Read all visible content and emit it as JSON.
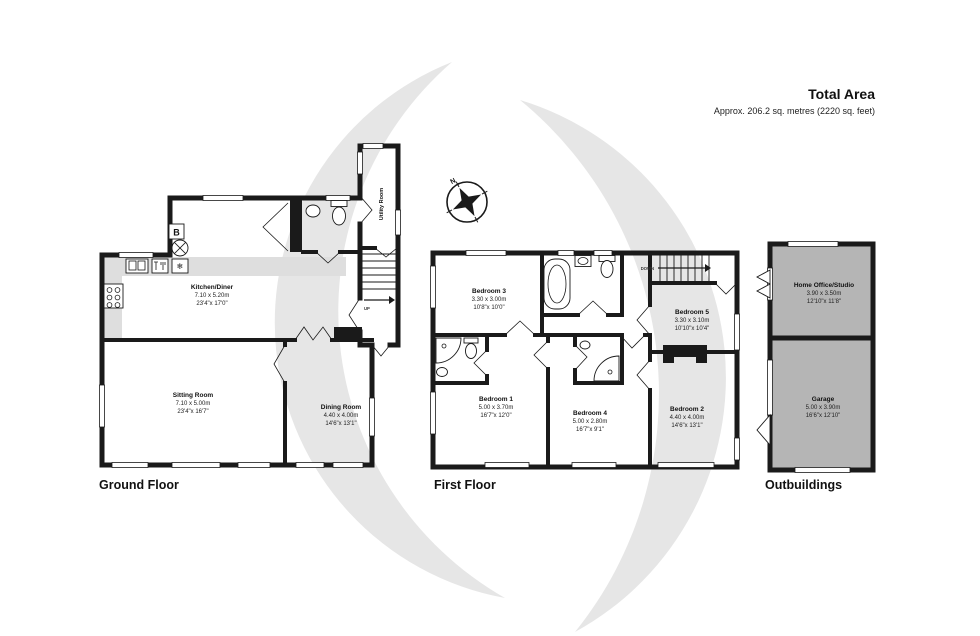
{
  "header": {
    "title": "Total Area",
    "subtitle": "Approx. 206.2 sq. metres (2220 sq. feet)"
  },
  "compass": {
    "north": "N"
  },
  "ground": {
    "label": "Ground Floor",
    "kitchen": {
      "name": "Kitchen/Diner",
      "metric": "7.10 x 5.20m",
      "imperial": "23'4\"x 17'0\""
    },
    "sitting": {
      "name": "Sitting Room",
      "metric": "7.10 x 5.00m",
      "imperial": "23'4\"x 16'7\""
    },
    "dining": {
      "name": "Dining Room",
      "metric": "4.40 x 4.00m",
      "imperial": "14'6\"x 13'1\""
    },
    "utility": {
      "name": "Utility Room"
    },
    "stairs_direction": "UP",
    "boiler_label": "B"
  },
  "first": {
    "label": "First Floor",
    "bedroom3": {
      "name": "Bedroom 3",
      "metric": "3.30 x 3.00m",
      "imperial": "10'8\"x 10'0\""
    },
    "bedroom5": {
      "name": "Bedroom 5",
      "metric": "3.30 x 3.10m",
      "imperial": "10'10\"x 10'4\""
    },
    "bedroom1": {
      "name": "Bedroom 1",
      "metric": "5.00 x 3.70m",
      "imperial": "16'7\"x 12'0\""
    },
    "bedroom4": {
      "name": "Bedroom 4",
      "metric": "5.00 x 2.80m",
      "imperial": "16'7\"x 9'1\""
    },
    "bedroom2": {
      "name": "Bedroom 2",
      "metric": "4.40 x 4.00m",
      "imperial": "14'6\"x 13'1\""
    },
    "stairs_direction": "DOWN"
  },
  "out": {
    "label": "Outbuildings",
    "office": {
      "name": "Home Office/Studio",
      "metric": "3.90 x 3.50m",
      "imperial": "12'10\"x 11'8\""
    },
    "garage": {
      "name": "Garage",
      "metric": "5.00 x 3.90m",
      "imperial": "16'6\"x 12'10\""
    }
  },
  "colors": {
    "wall": "#1a1a1a",
    "watermark": "#e6e6e6",
    "outbuilding_fill": "#b5b5b5",
    "counter_fill": "#dedede"
  }
}
